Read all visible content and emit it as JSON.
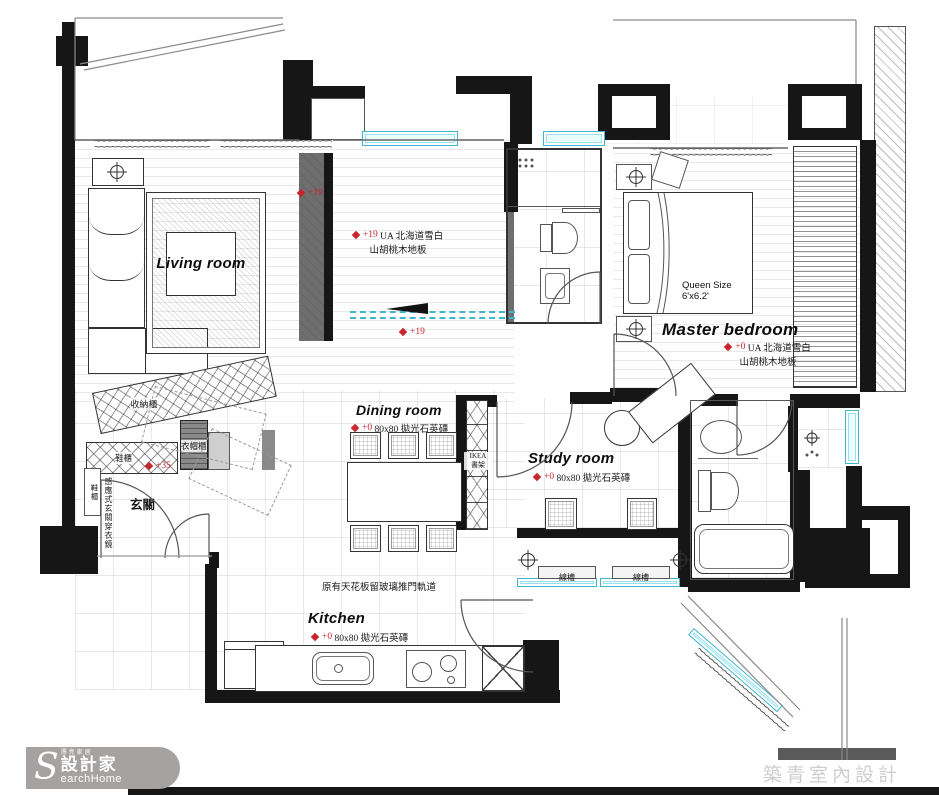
{
  "rooms": {
    "living": "Living room",
    "master": "Master bedroom",
    "dining": "Dining room",
    "study": "Study room",
    "kitchen": "Kitchen",
    "entry": "玄關"
  },
  "levels": {
    "p19": "+19",
    "p0": "+0",
    "p35": "+35"
  },
  "notes": {
    "wood_line1": "UA 北海道雪白",
    "wood_line2": "山胡桃木地板",
    "tile": "80x80 拋光石英磚",
    "ceiling": "原有天花板留玻璃推門軌道",
    "cable_tray": "線槽"
  },
  "furniture": {
    "bed_line1": "Queen Size",
    "bed_line2": "6'x6.2'",
    "bookshelf_line1": "IKEA",
    "bookshelf_line2": "書架"
  },
  "entry_items": {
    "storage_cabinet": "收納櫃",
    "shoe_cabinet": "鞋櫃",
    "coat_cabinet": "衣帽櫃",
    "shoe_cabinet2": "鞋櫃",
    "mirror": "感應式玄關穿衣鏡"
  },
  "footer": {
    "logo_tagline": "漂亮家居",
    "logo_name": "設計家",
    "logo_s": "S",
    "logo_rest": "earchHome",
    "credit": "築青室內設計"
  },
  "icons": {
    "wave_pattern": "~~~~~~~~~~~~~~~~~~~~~~~~~~~~~~~~~~~~~~"
  },
  "colors": {
    "wall": "#161616",
    "window": "#3fb6cd",
    "marker_red": "#c8262c",
    "logo_gray": "#a6a2a2"
  }
}
